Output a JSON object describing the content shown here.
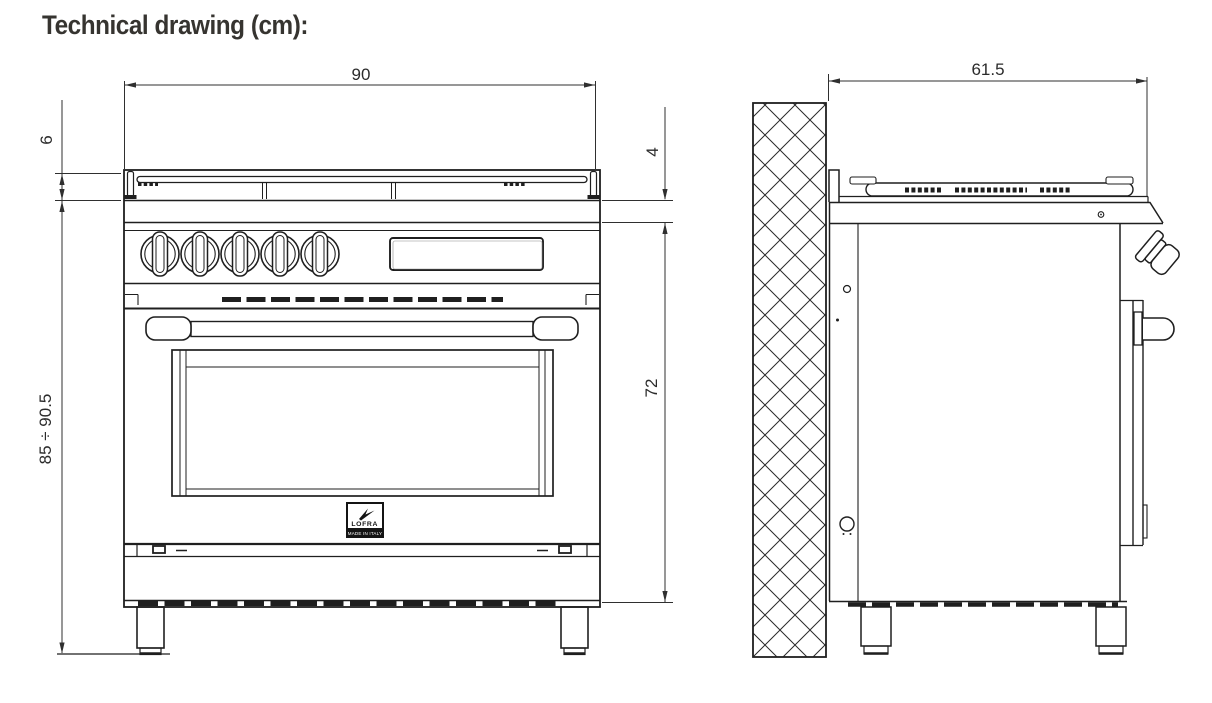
{
  "title": "Technical drawing (cm):",
  "front_view": {
    "dim_width": "90",
    "dim_grate_height": "6",
    "dim_total_height": "85 ÷ 90.5",
    "dim_rim_height": "4",
    "dim_body_height": "72",
    "logo_brand": "LOFRA",
    "logo_origin": "MADE IN ITALY"
  },
  "side_view": {
    "dim_depth": "61.5"
  },
  "colors": {
    "line": "#1f1f1f",
    "dimension": "#2f2f2f",
    "title": "#363430",
    "background": "#ffffff"
  }
}
